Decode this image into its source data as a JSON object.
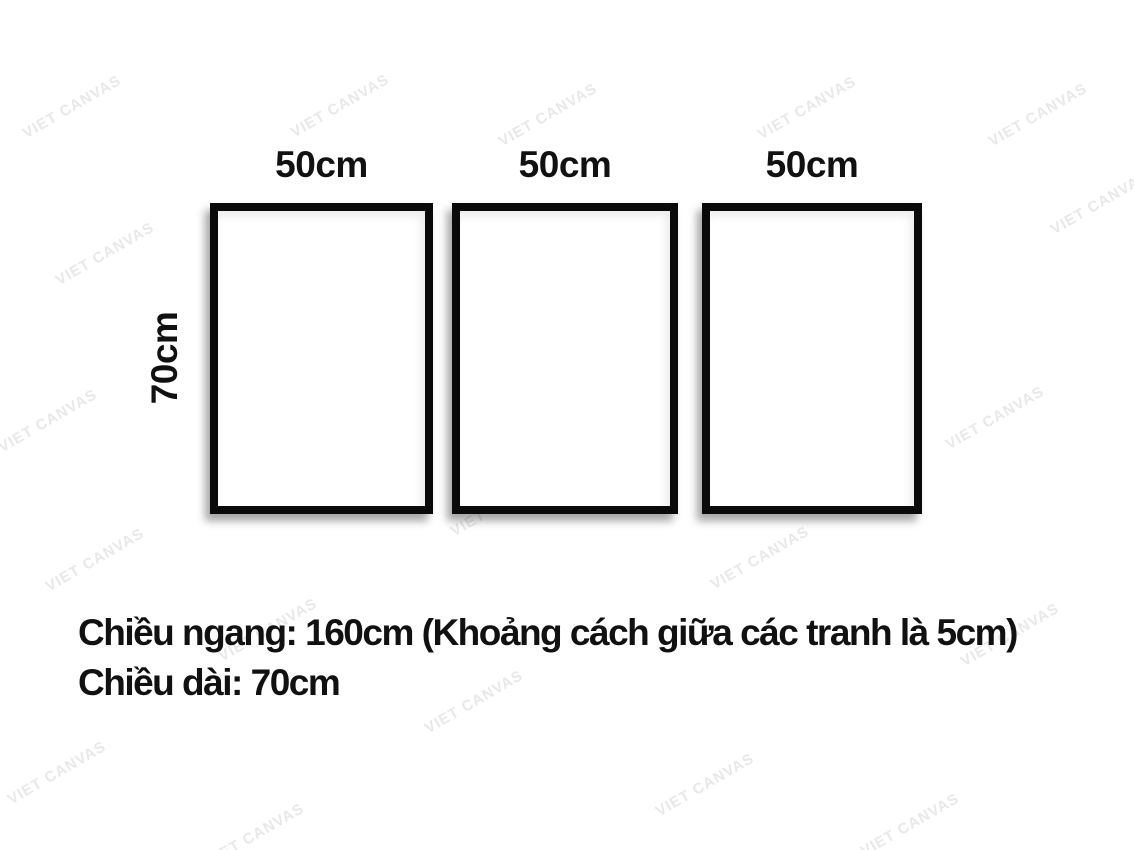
{
  "watermark": {
    "text": "VIET CANVAS",
    "color": "#e8e8e8",
    "angle_deg": -30,
    "positions": [
      [
        72,
        107
      ],
      [
        340,
        106
      ],
      [
        548,
        115
      ],
      [
        807,
        108
      ],
      [
        1038,
        115
      ],
      [
        1100,
        203
      ],
      [
        105,
        254
      ],
      [
        288,
        282
      ],
      [
        545,
        288
      ],
      [
        788,
        360
      ],
      [
        995,
        418
      ],
      [
        343,
        415
      ],
      [
        48,
        421
      ],
      [
        500,
        505
      ],
      [
        760,
        558
      ],
      [
        95,
        560
      ],
      [
        268,
        630
      ],
      [
        1010,
        635
      ],
      [
        474,
        702
      ],
      [
        57,
        773
      ],
      [
        705,
        785
      ],
      [
        255,
        835
      ],
      [
        910,
        825
      ]
    ]
  },
  "frames": [
    {
      "width_label": "50cm"
    },
    {
      "width_label": "50cm"
    },
    {
      "width_label": "50cm"
    }
  ],
  "height_label": "70cm",
  "notes": {
    "line1": "Chiều ngang: 160cm (Khoảng cách giữa các tranh là 5cm)",
    "line2": "Chiều dài: 70cm"
  },
  "colors": {
    "frame_border": "#0a0a0a",
    "text": "#111111"
  }
}
